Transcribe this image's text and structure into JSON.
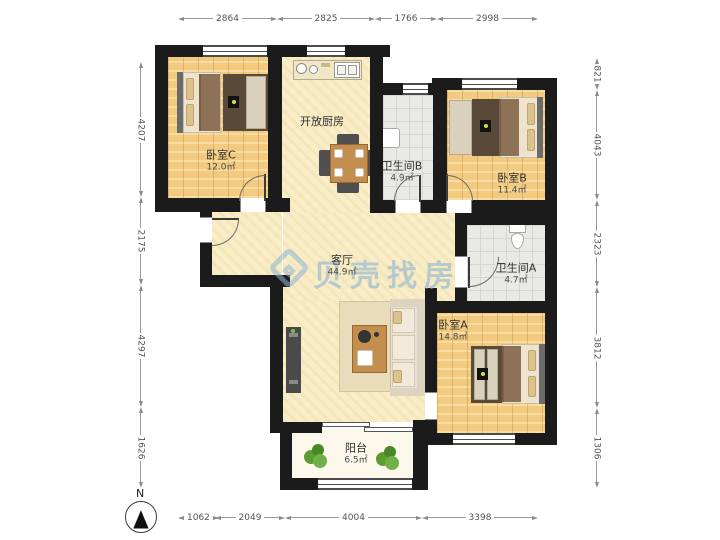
{
  "watermark": {
    "logo": "beike-shell-logo",
    "text": "贝壳找房"
  },
  "compass": {
    "north_label": "N"
  },
  "rooms": [
    {
      "name": "卧室C",
      "area": "12.0㎡"
    },
    {
      "name": "开放厨房",
      "area": ""
    },
    {
      "name": "卫生间B",
      "area": "4.9㎡"
    },
    {
      "name": "卧室B",
      "area": "11.4㎡"
    },
    {
      "name": "客厅",
      "area": "44.9㎡"
    },
    {
      "name": "卫生间A",
      "area": "4.7㎡"
    },
    {
      "name": "卧室A",
      "area": "14.8㎡"
    },
    {
      "name": "阳台",
      "area": "6.5㎡"
    }
  ],
  "dimensions": {
    "top": [
      "2864",
      "2825",
      "1766",
      "2998"
    ],
    "left": [
      "4207",
      "2175",
      "4297",
      "1626"
    ],
    "right": [
      "821",
      "4043",
      "2323",
      "3812",
      "1306"
    ],
    "bottom": [
      "1062",
      "2049",
      "4004",
      "3398"
    ]
  },
  "colors": {
    "wall": "#1b1b1b",
    "wood_floor": "#f2cb80",
    "living_floor": "#f8edc6",
    "tile_floor": "#e9e9e5",
    "balcony_floor": "#fcf9ec",
    "watermark": "#8eb4d6"
  }
}
